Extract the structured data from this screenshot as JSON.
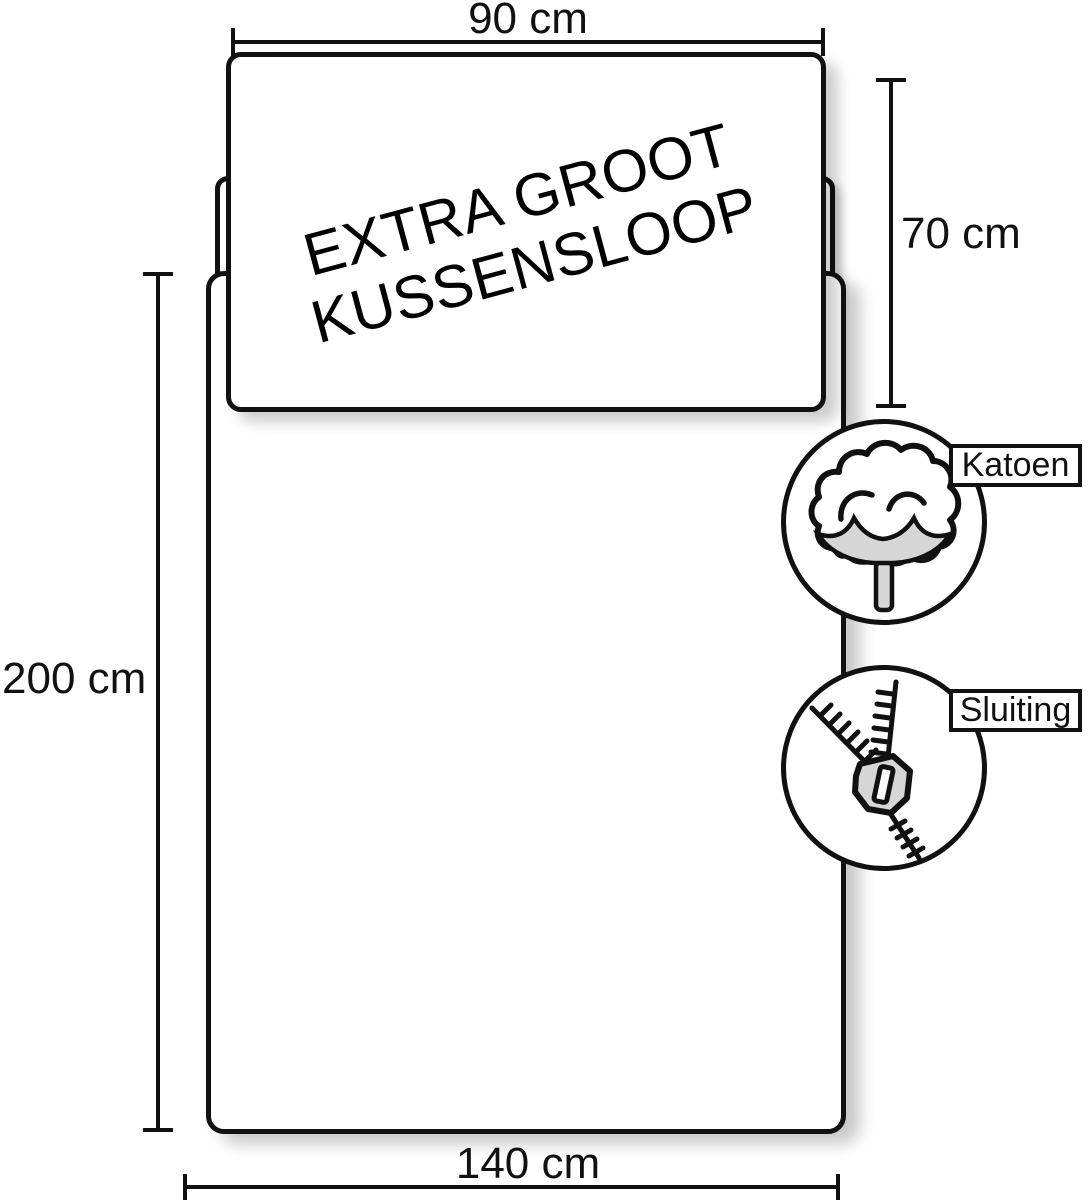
{
  "diagram": {
    "pillow_title_line1": "EXTRA GROOT",
    "pillow_title_line2": "KUSSENSLOOP",
    "dimensions": {
      "pillow_width": "90 cm",
      "pillow_height": "70 cm",
      "duvet_length": "200 cm",
      "duvet_width": "140 cm"
    },
    "badges": [
      {
        "label": "Katoen",
        "icon": "cotton-icon"
      },
      {
        "label": "Sluiting",
        "icon": "zipper-icon"
      }
    ],
    "colors": {
      "outline": "#111111",
      "surface": "#ffffff",
      "icon_gray": "#d6d6d6"
    }
  }
}
